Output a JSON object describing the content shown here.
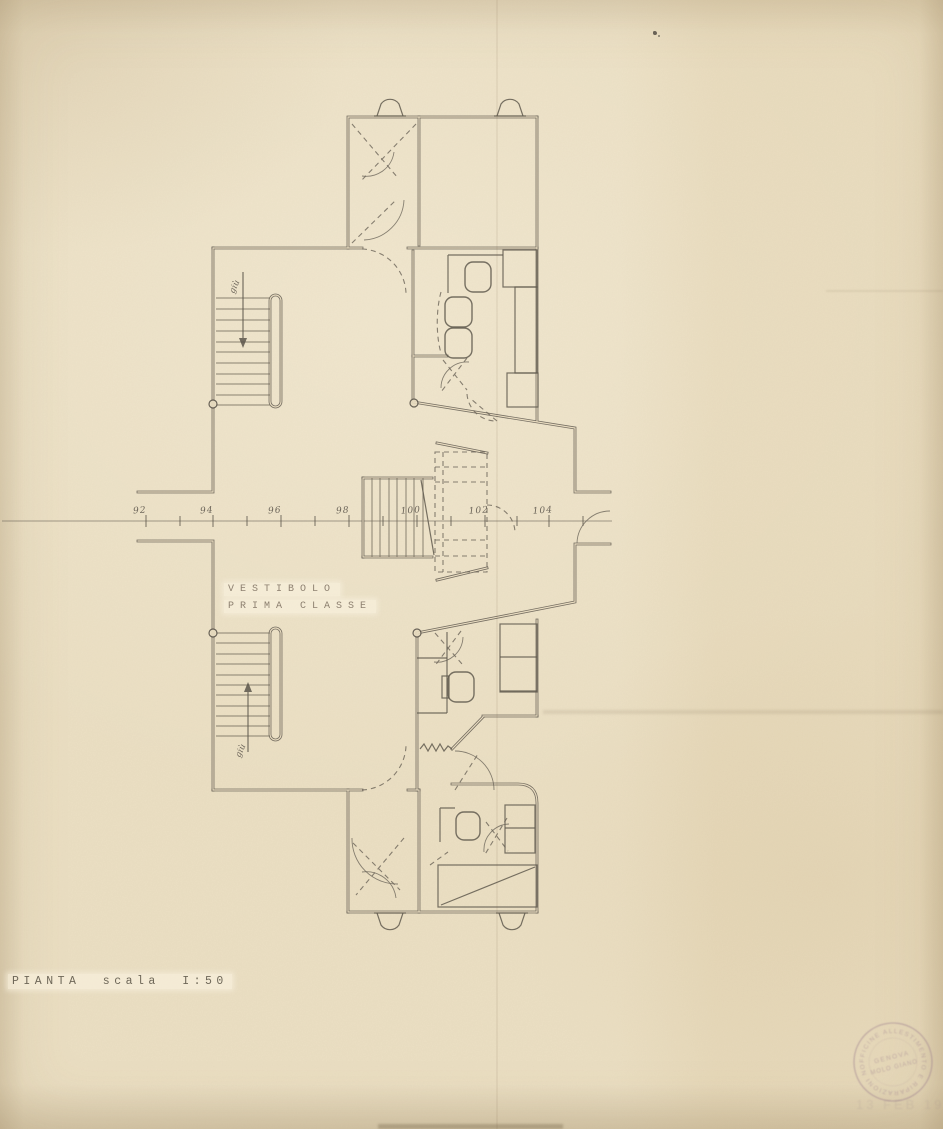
{
  "plan": {
    "room_label": {
      "line1": "VESTIBOLO",
      "line2": "PRIMA CLASSE"
    },
    "scale_caption": "PIANTA scala I:50",
    "centerline": {
      "stations": [
        {
          "label": "92"
        },
        {
          "label": "94"
        },
        {
          "label": "96"
        },
        {
          "label": "98"
        },
        {
          "label": "100"
        },
        {
          "label": "102"
        },
        {
          "label": "104"
        }
      ]
    },
    "stairs": {
      "upper_direction_label": "giù",
      "lower_direction_label": "giù"
    }
  },
  "stamp": {
    "ring_text": "OFFICINE ALLESTIMENTO E RIPARAZIONI NAVI",
    "center_line1": "GENOVA",
    "center_line2": "MOLO GIANO",
    "date_mark": "13 FEB 1931"
  },
  "colors": {
    "paper": "#ebdfc3",
    "ink": "#59534a",
    "typed_text": "#8d8070",
    "stamp_ink": "#9b7e92"
  }
}
